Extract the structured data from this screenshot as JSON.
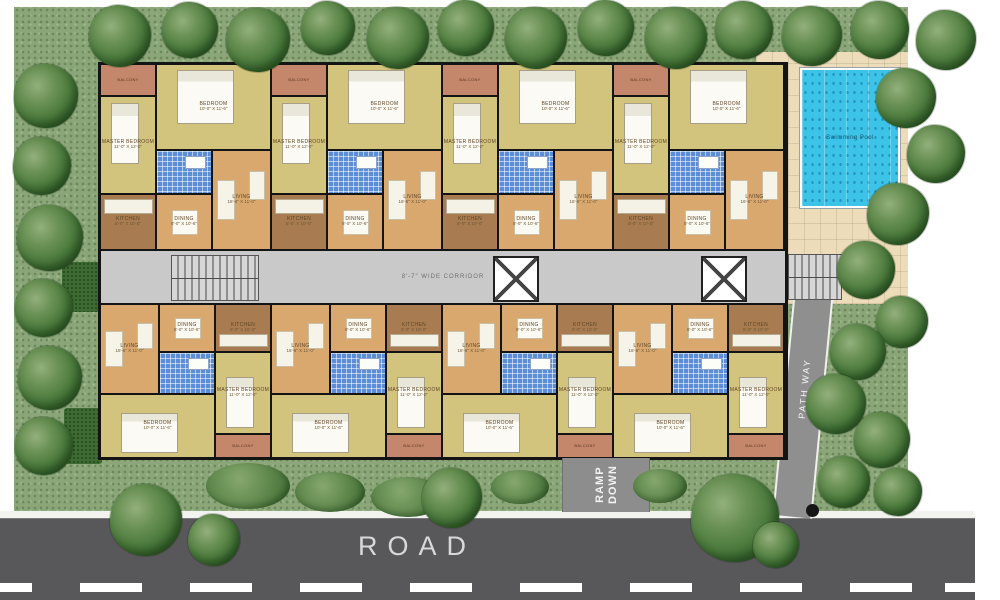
{
  "plan": {
    "road_label": "ROAD",
    "ramp_line1": "RAMP",
    "ramp_line2": "DOWN",
    "pathway_label": "PATH WAY",
    "pool_label": "Swimming Pool",
    "corridor_label": "8'-7\" WIDE CORRIDOR"
  },
  "room_labels": {
    "master_bedroom": "MASTER BEDROOM",
    "bedroom": "BEDROOM",
    "kitchen": "KITCHEN",
    "living": "LIVING",
    "dining": "DINING",
    "balcony": "BALCONY",
    "toilet": "TOILET"
  },
  "room_dims": {
    "master_bedroom": "11'-0\" X 12'-0\"",
    "bedroom": "10'-0\" X 11'-6\"",
    "kitchen": "8'-0\" X 10'-0\"",
    "living": "16'-6\" X 11'-0\"",
    "dining": "8'-0\" X 10'-6\""
  },
  "colors": {
    "lawn": "#8ba679",
    "tree_mid": "#4a7a3c",
    "tree_dark": "#2e5426",
    "road": "#58585a",
    "marking": "#ffffff",
    "pool_water": "#3cc4e8",
    "pool_deck": "#ecdcba",
    "corridor": "#c9c9c9",
    "wall": "#141414",
    "living": "#d9a86f",
    "bedroom": "#d3c47d",
    "kitchen": "#a87c50",
    "balcony": "#c4876b",
    "toilet": "#5b8ed6",
    "pathway": "#8f8f8f"
  }
}
